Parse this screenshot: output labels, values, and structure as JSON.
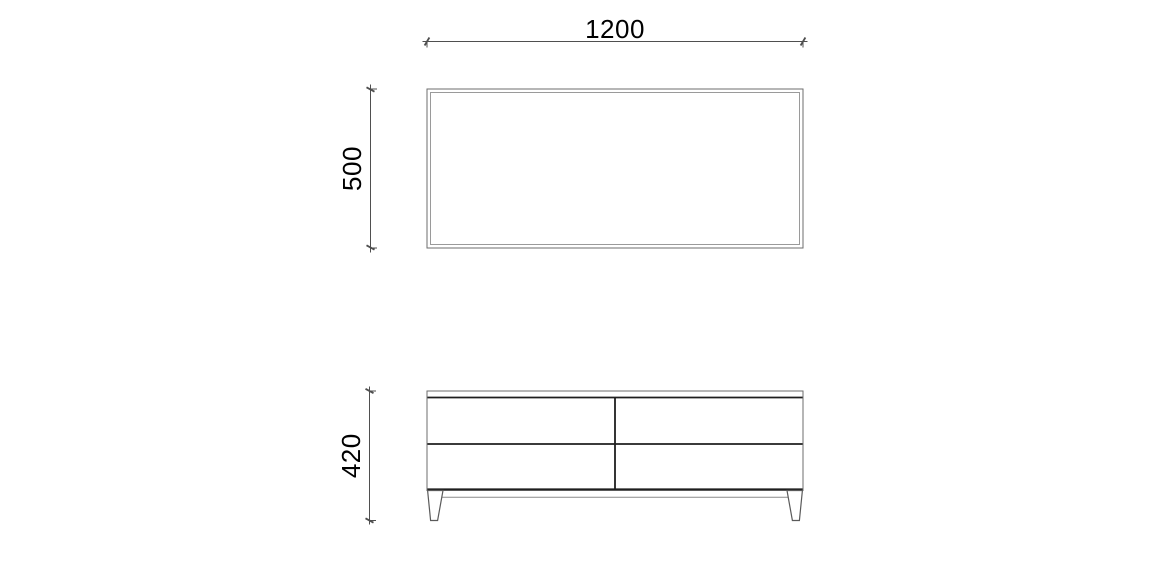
{
  "drawing": {
    "dimensions": {
      "width": {
        "value": "1200"
      },
      "depth": {
        "value": "500"
      },
      "height": {
        "value": "420"
      }
    },
    "colors": {
      "background": "#ffffff",
      "outline": "#6e6e6e",
      "outline_inner": "#9a9a9a",
      "drawer_line": "#1f1f1f",
      "leg_line": "#5a5a5a",
      "rail_line": "#8a8a8a",
      "dimension_line": "#4f4f4f",
      "dimension_text": "#000000"
    }
  }
}
